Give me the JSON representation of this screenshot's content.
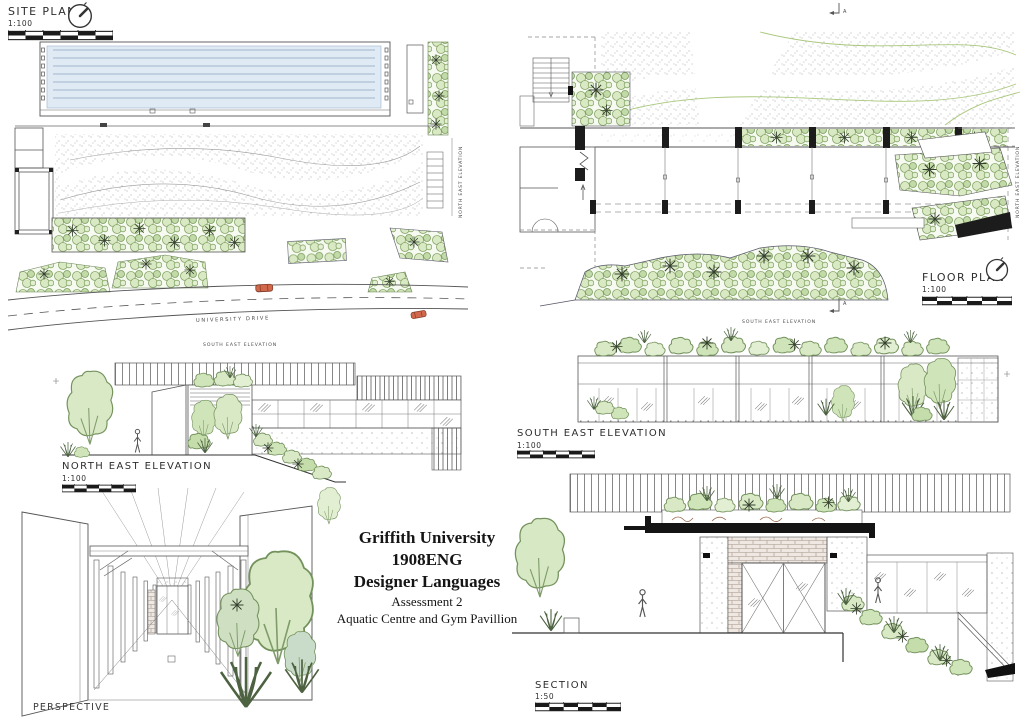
{
  "sheet": {
    "title_block": {
      "line1": "Griffith University",
      "line2": "1908ENG",
      "line3": "Designer Languages",
      "line4": "Assessment 2",
      "line5": "Aquatic Centre and Gym Pavillion"
    },
    "panels": {
      "site_plan": {
        "title": "SITE PLAN",
        "scale": "1:100"
      },
      "floor_plan": {
        "title": "FLOOR PLAN",
        "scale": "1:100"
      },
      "ne_elevation": {
        "title": "NORTH EAST ELEVATION",
        "scale": "1:100"
      },
      "se_elevation": {
        "title": "SOUTH EAST ELEVATION",
        "scale": "1:100"
      },
      "perspective": {
        "title": "PERSPECTIVE"
      },
      "section": {
        "title": "SECTION",
        "scale": "1:50"
      }
    },
    "annotations": {
      "university_drive": "UNIVERSITY DRIVE",
      "site_plan_se_edge": "SOUTH EAST ELEVATION",
      "site_plan_ne_edge": "NORTH EAST ELEVATION",
      "floor_plan_ne_edge": "NORTH EAST ELEVATION",
      "floor_plan_se_edge": "SOUTH EAST ELEVATION",
      "section_marker_top": "A",
      "section_marker_bottom": "A"
    },
    "icons": {
      "north_arrow": "north-arrow-compass",
      "scale_bar": "graphic-scale-bar"
    },
    "colors": {
      "pool_water": "#dfeaf4",
      "foliage_light": "#d9e9c6",
      "foliage_mid": "#cfe4b8",
      "foliage_pale": "#e2efd2",
      "foliage_grey": "#c9dcc9",
      "foliage_dark_accent": "#333f2c",
      "car": "#d2684b",
      "ink": "#4a4a4a",
      "canopy_black": "#141414",
      "contour_green": "#a9c77c",
      "root_brown": "#9b6a4f"
    }
  }
}
